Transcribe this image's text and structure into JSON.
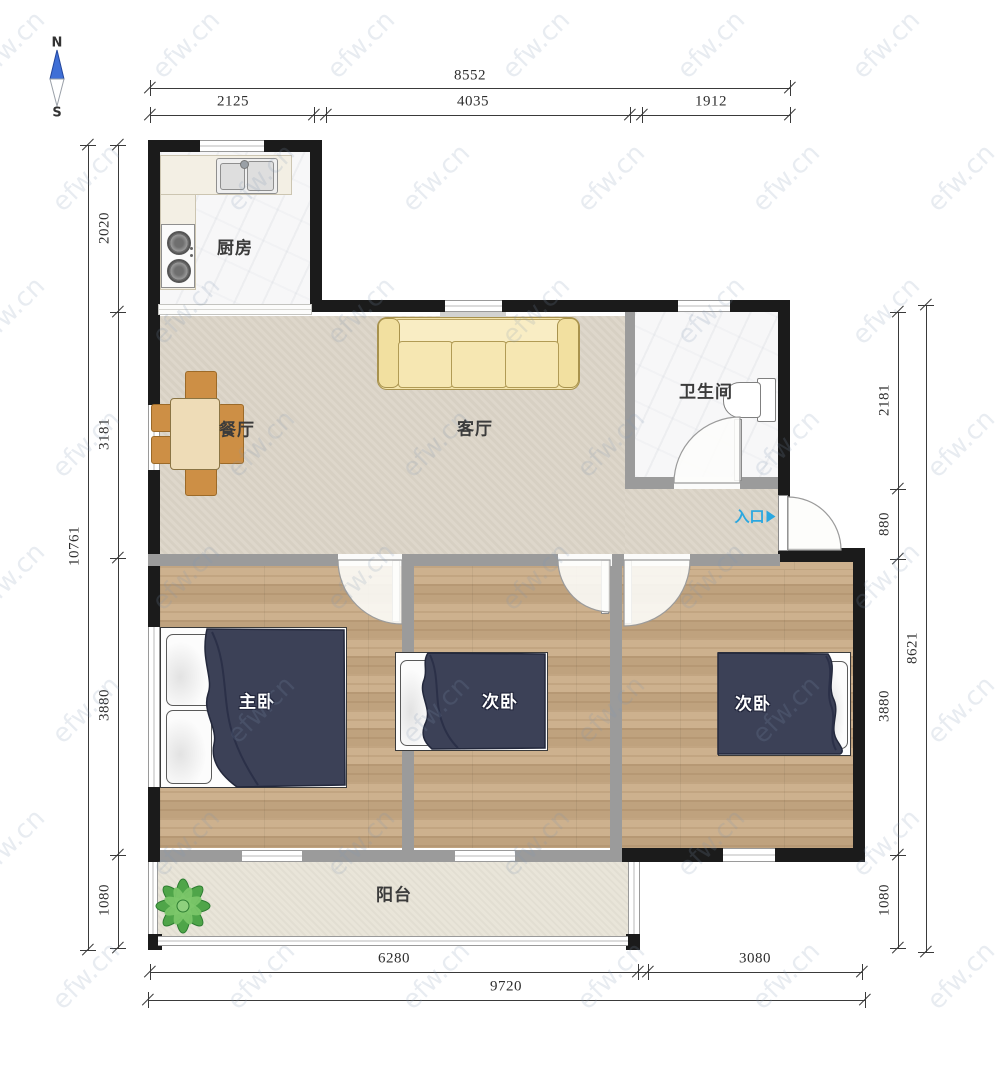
{
  "compass": {
    "north_label": "N",
    "south_label": "S"
  },
  "watermark_text": "efw.cn",
  "rooms": {
    "kitchen": {
      "label": "厨房"
    },
    "dining": {
      "label": "餐厅"
    },
    "living": {
      "label": "客厅"
    },
    "bathroom": {
      "label": "卫生间"
    },
    "master_bedroom": {
      "label": "主卧"
    },
    "bedroom_2": {
      "label": "次卧"
    },
    "bedroom_3": {
      "label": "次卧"
    },
    "balcony": {
      "label": "阳台"
    }
  },
  "entrance": {
    "label": "入口"
  },
  "dimensions": {
    "top": {
      "total": "8552",
      "segments": [
        "2125",
        "4035",
        "1912"
      ]
    },
    "left": {
      "total": "10761",
      "segments": [
        "2020",
        "3181",
        "3880",
        "1080"
      ]
    },
    "right": {
      "total": "8621",
      "segments": [
        "2181",
        "880",
        "3880",
        "1080"
      ]
    },
    "bottom": {
      "total": "9720",
      "segments": [
        "6280",
        "3080"
      ]
    }
  },
  "colors": {
    "exterior_wall": "#1b1b1b",
    "interior_wall": "#9b9b9b",
    "wood_floor": "#c9ab85",
    "living_floor": "#dcd5c8",
    "tile_floor": "#f7f7f8",
    "balcony_floor": "#e9e5d9",
    "duvet": "#3c4157",
    "sofa": "#f5e5ab",
    "chair": "#cd8f45",
    "table": "#eedcb7",
    "plant": "#4fa549",
    "entrance_accent": "#2aa7e0",
    "dimension_ink": "#3a3a3a",
    "compass_north": "#3f6fd6"
  }
}
